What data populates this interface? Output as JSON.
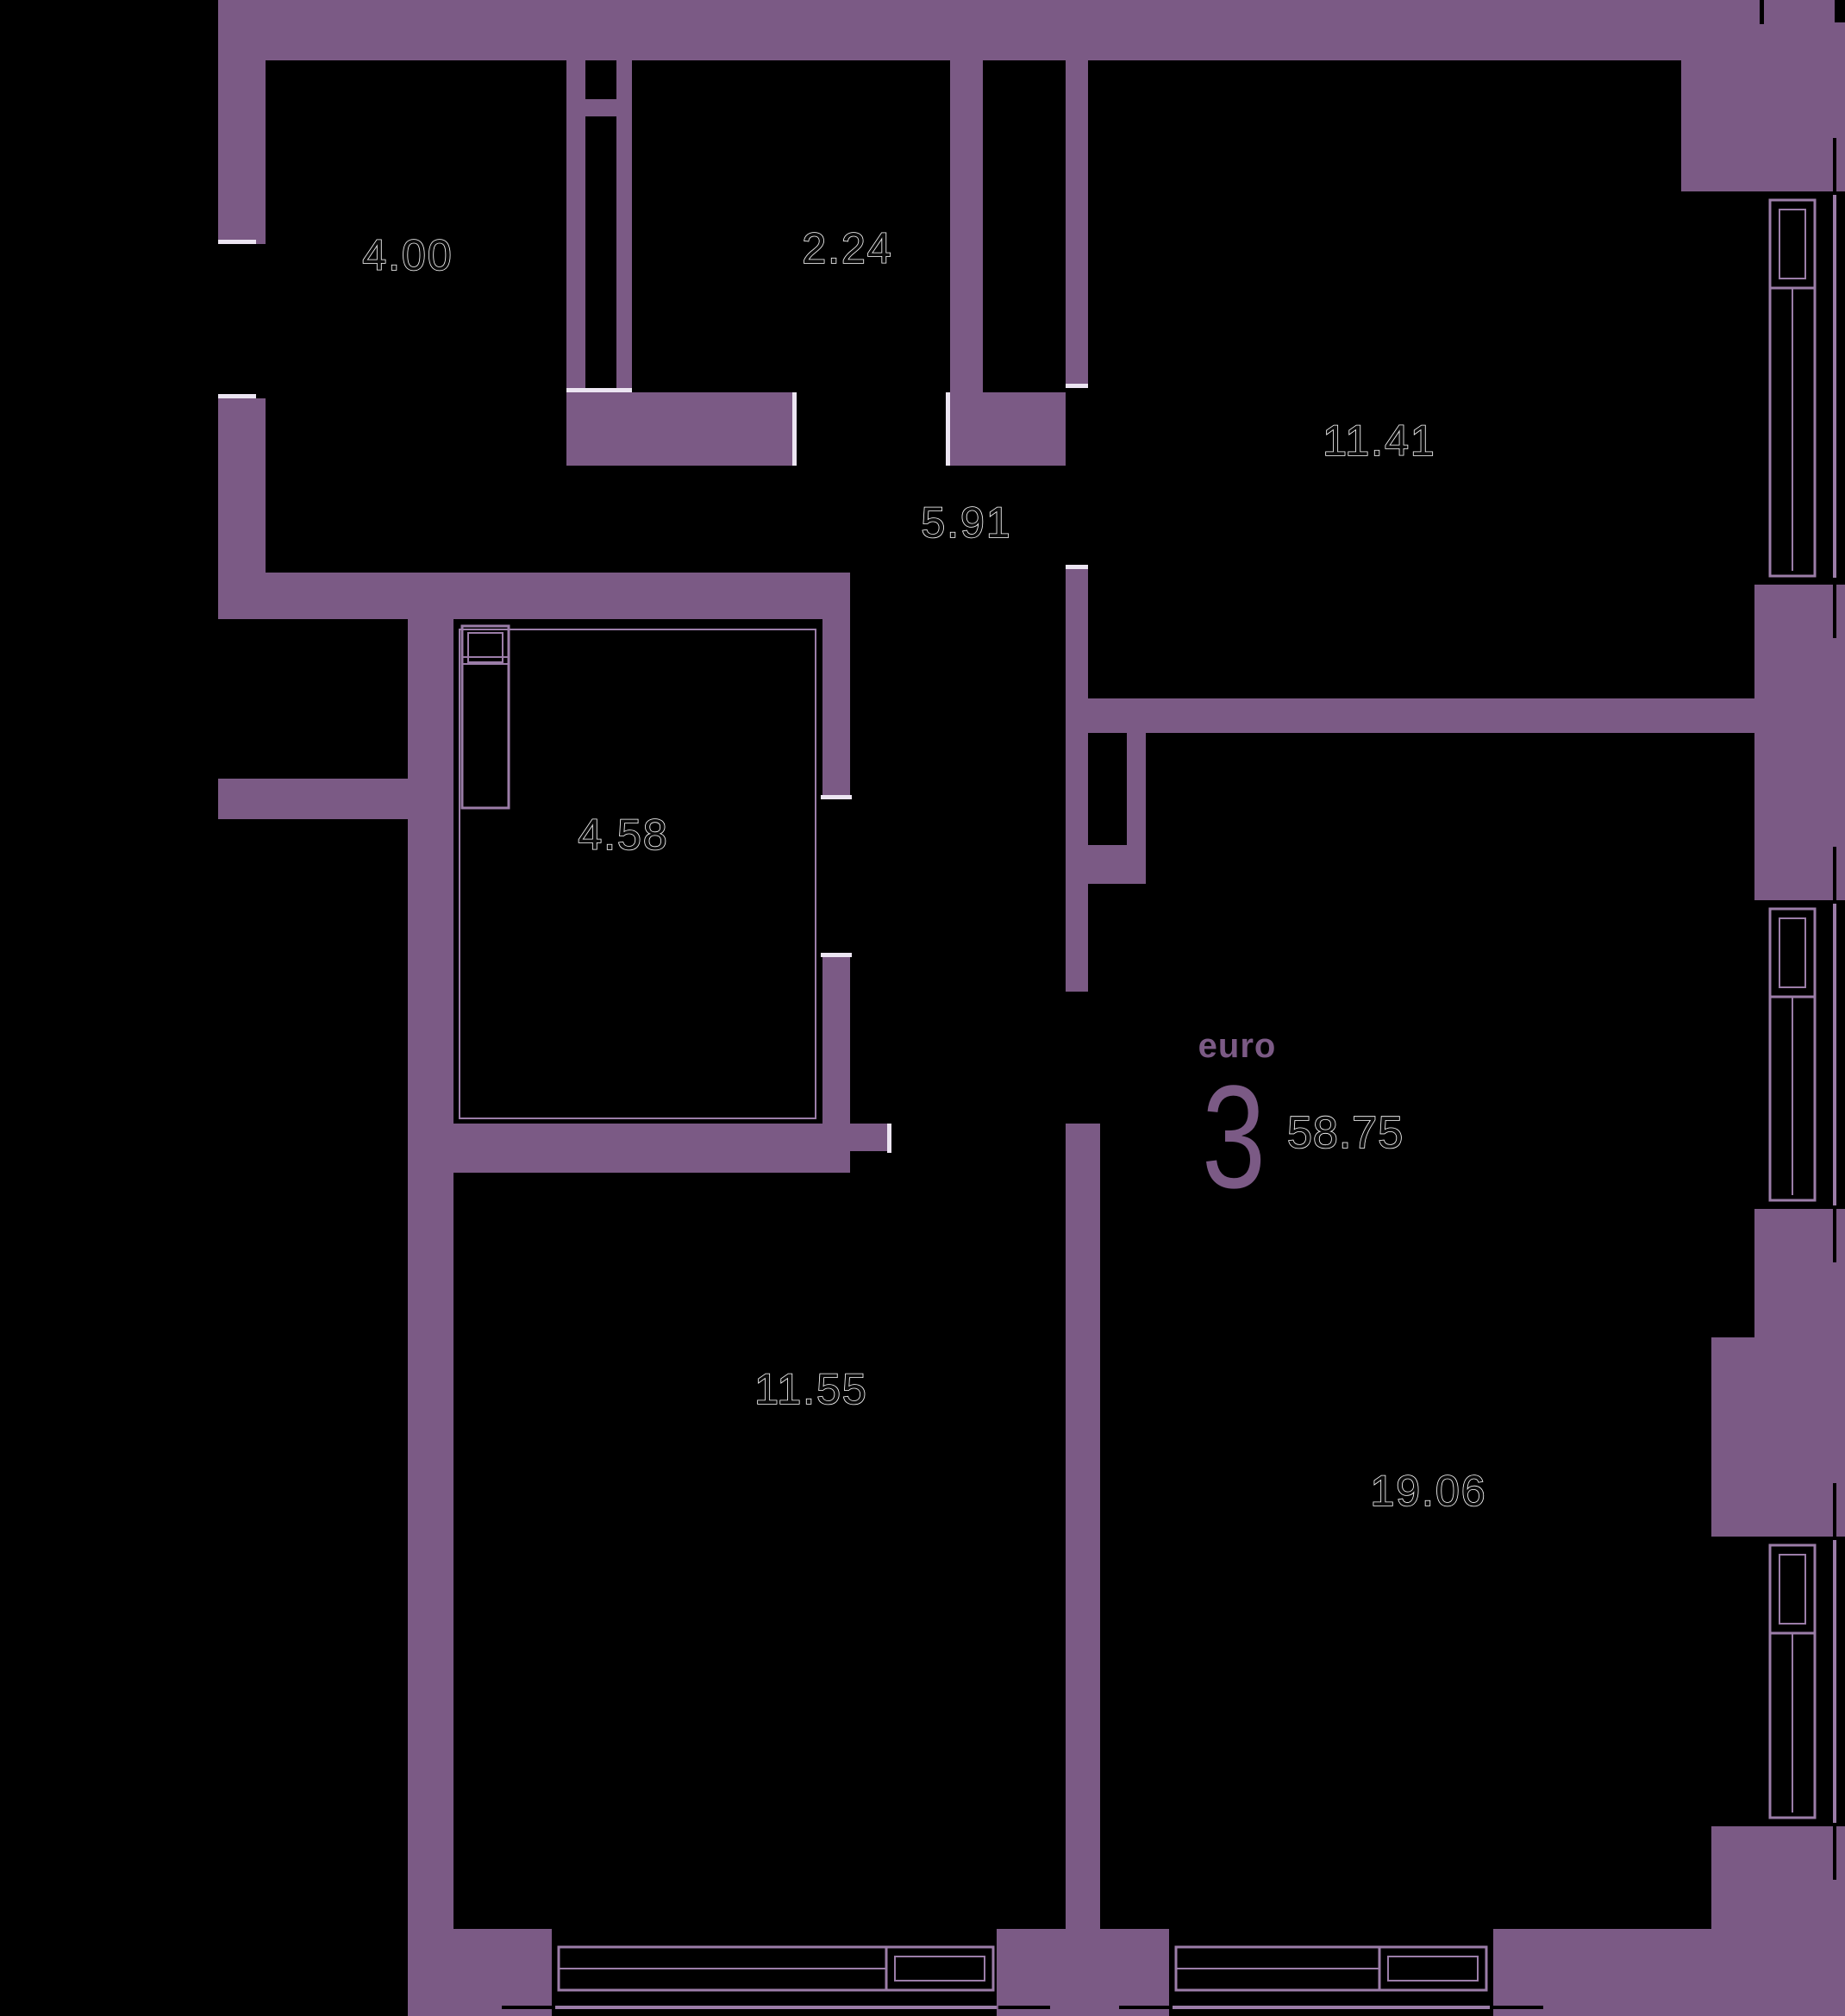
{
  "plan": {
    "unit": {
      "brand": "euro",
      "rooms_count": "3",
      "total_area": "58.75"
    },
    "rooms": [
      {
        "name": "hallway",
        "area": "4.00"
      },
      {
        "name": "storage",
        "area": "2.24"
      },
      {
        "name": "corridor",
        "area": "5.91"
      },
      {
        "name": "bedroom-top-right",
        "area": "11.41"
      },
      {
        "name": "bathroom",
        "area": "4.58"
      },
      {
        "name": "bedroom-bottom-left",
        "area": "11.55"
      },
      {
        "name": "living-room",
        "area": "19.06"
      }
    ],
    "colors": {
      "wall": "#7b5a85",
      "line": "#9b7da8",
      "jamb": "#ece5f2",
      "background": "#000000",
      "label_fill": "#0a0a0a",
      "label_outline": "#ffffff",
      "brand": "#7b5a85"
    }
  }
}
